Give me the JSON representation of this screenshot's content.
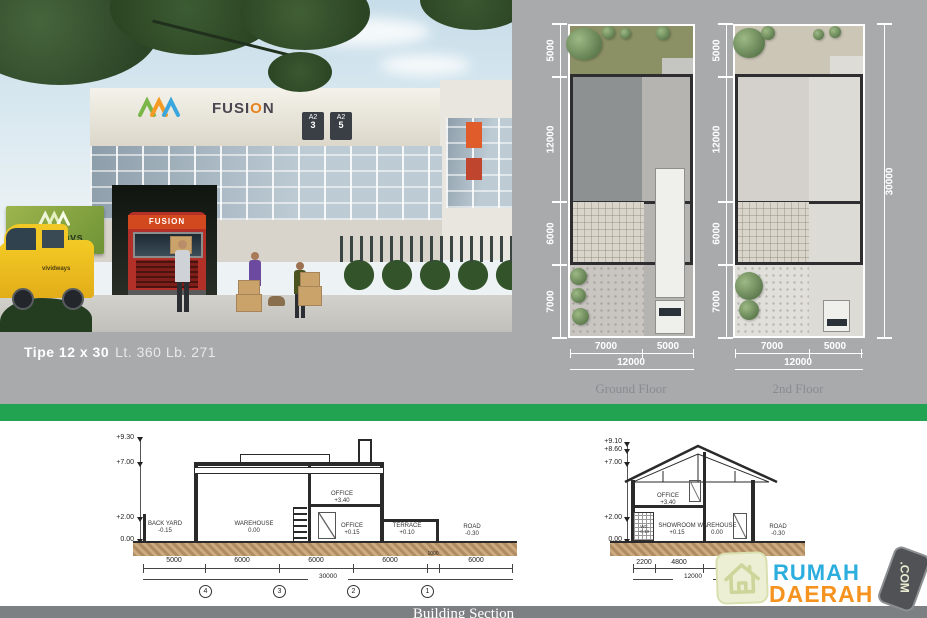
{
  "listing": {
    "type_label": "Tipe 12 x 30",
    "area_label": "Lt. 360 Lb. 271"
  },
  "photo": {
    "fusion_a": "FUSI",
    "fusion_o": "O",
    "fusion_b": "N",
    "board_text": "vividways",
    "truck_text": "FUSION",
    "plate1_top": "A2",
    "plate1_num": "3",
    "plate2_top": "A2",
    "plate2_num": "5"
  },
  "plans": {
    "left_dims": [
      "5000",
      "12000",
      "6000",
      "7000"
    ],
    "bottom_dims": [
      "7000",
      "5000"
    ],
    "bottom_total": "12000",
    "overall_height": "30000",
    "ground_caption": "Ground Floor",
    "second_caption": "2nd Floor"
  },
  "section_left": {
    "elev": [
      "+9.30",
      "+7.00",
      "+2.00",
      "0.00"
    ],
    "rooms": [
      [
        "BACK YARD",
        "-0.15"
      ],
      [
        "WAREHOUSE",
        "0.00"
      ],
      [
        "OFFICE",
        "+3.40"
      ],
      [
        "OFFICE",
        "+0.15"
      ],
      [
        "TERRACE",
        "+0.10"
      ],
      [
        "ROAD",
        "-0.30"
      ]
    ],
    "dims": [
      "5000",
      "6000",
      "6000",
      "6000",
      "1000",
      "6000"
    ],
    "total": "30000",
    "grid": [
      "4",
      "3",
      "2",
      "1"
    ]
  },
  "section_right": {
    "elev": [
      "+9.10",
      "+8.60",
      "+7.00",
      "+2.00",
      "0.00"
    ],
    "rooms": [
      [
        "OFFICE",
        "+3.40"
      ],
      [
        "WC",
        "-0.10"
      ],
      [
        "SHOWROOM",
        "+0.15"
      ],
      [
        "WAREHOUSE",
        "0.00"
      ],
      [
        "ROAD",
        "-0.30"
      ]
    ],
    "dims": [
      "2200",
      "4800",
      "5000"
    ],
    "total": "12000"
  },
  "footer": {
    "caption": "Building Section"
  },
  "logo": {
    "word1": "RUMAH",
    "word2": "DAERAH",
    "badge": ".COM"
  },
  "colors": {
    "accent_green": "#22a351",
    "logo_blue": "#2badde",
    "logo_orange": "#f6921e"
  }
}
